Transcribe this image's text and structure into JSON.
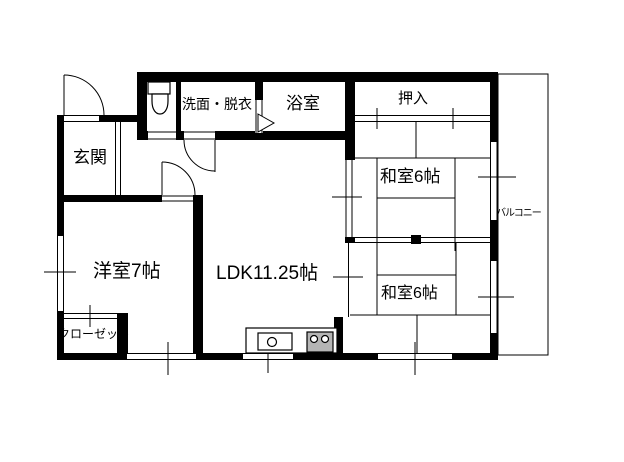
{
  "title": "apartment-floor-plan",
  "colors": {
    "line": "#000000",
    "stove_fill": "#b5b5b5",
    "background": "#ffffff"
  },
  "rooms": {
    "genkan": {
      "label": "玄関"
    },
    "washroom": {
      "label": "洗面・脱衣"
    },
    "bathroom": {
      "label": "浴室"
    },
    "oshiire": {
      "label": "押入"
    },
    "washitsu_upper": {
      "label": "和室6帖"
    },
    "washitsu_lower": {
      "label": "和室6帖"
    },
    "yoshitsu": {
      "label": "洋室7帖"
    },
    "ldk": {
      "label": "LDK11.25帖"
    },
    "closet": {
      "label": "クローゼット"
    },
    "balcony": {
      "label": "バルコニー"
    }
  }
}
